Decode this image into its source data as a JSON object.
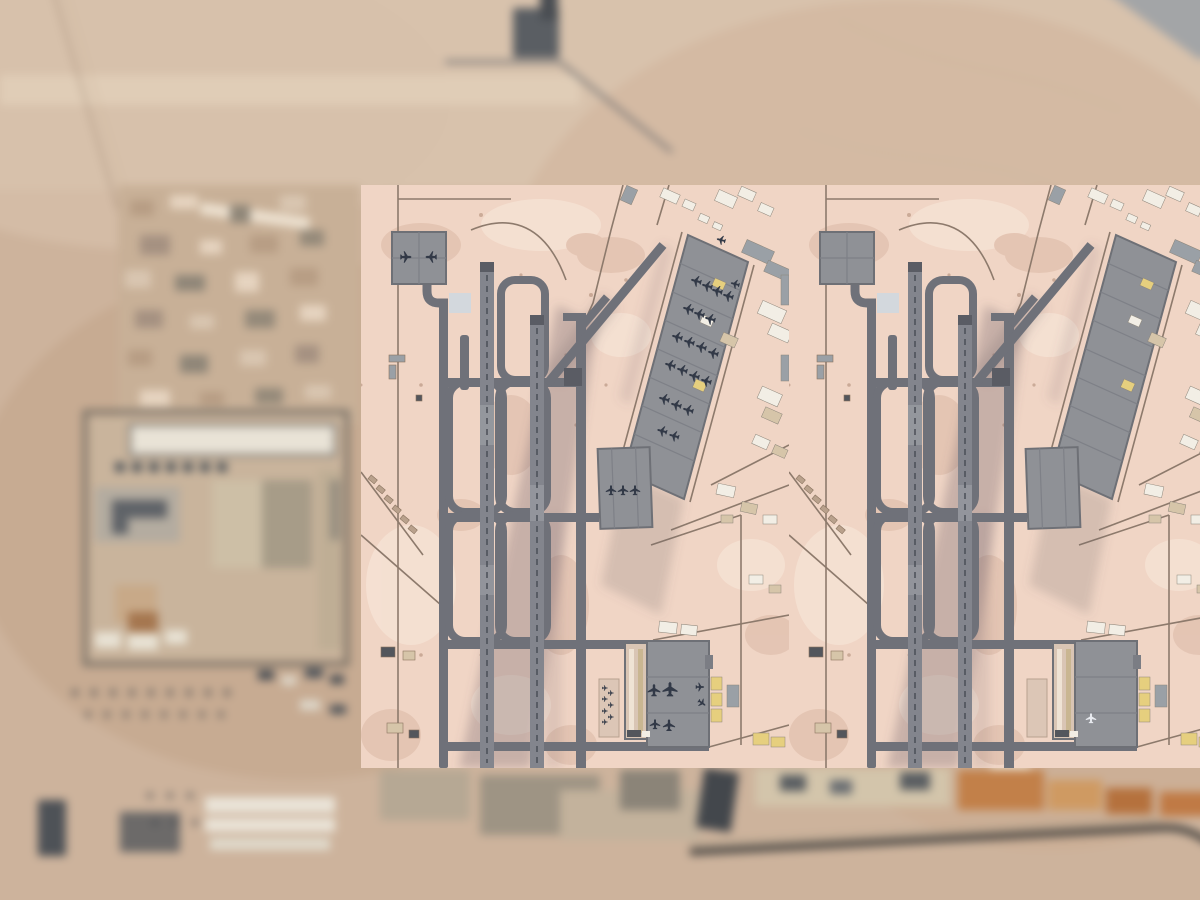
{
  "meta": {
    "description": "Composite satellite imagery: two crisp overhead panels of a desert airbase (runways, taxiways, parking aprons) laid over a blurred low-resolution aerial photograph of the same base",
    "content_type": "satellite-photo-comparison",
    "visible_text": ""
  },
  "colors": {
    "desert_base": "#cdb39c",
    "desert_light": "#dcc6b0",
    "panel_sand": "#f0d5c5",
    "mottle_dark": "#dbb8a5",
    "mottle_light": "#f9e9dc",
    "runway": "#83858d",
    "pavement": "#6f7179",
    "pavement_dark": "#5a5c64",
    "centerline": "#4b4e57",
    "apron": "#8f9196",
    "apron_edge": "#6e7076",
    "apron_lane": "#7e8087",
    "shadow": "#6b5e66",
    "road_thin": "#8d7a6c",
    "building_white": "#f2eee5",
    "building_tan": "#d6c5a9",
    "building_yellow": "#e6cf7e",
    "building_gray": "#9aa0a6",
    "dark_structure": "#53565c",
    "compound_wall": "#6f6a62",
    "road_dark": "#4b4844",
    "roof_orange": "#c28049",
    "roof_orange2": "#cf9a62",
    "plane": "#323947",
    "plane_light": "#e8eaef"
  },
  "panels": [
    {
      "id": "left",
      "name": "satellite-panel-left",
      "aircraft_visible": true,
      "aircraft_count": 40
    },
    {
      "id": "right",
      "name": "satellite-panel-right",
      "aircraft_visible": false,
      "aircraft_count": 1
    }
  ],
  "aircraft": {
    "left_panel": [
      {
        "x": 45,
        "y": 72,
        "r": 90,
        "s": 1.0
      },
      {
        "x": 70,
        "y": 72,
        "r": -90,
        "s": 1.0
      },
      {
        "x": 335,
        "y": 96,
        "r": -75,
        "s": 0.95
      },
      {
        "x": 346,
        "y": 101,
        "r": -75,
        "s": 0.95
      },
      {
        "x": 356,
        "y": 106,
        "r": -75,
        "s": 0.95
      },
      {
        "x": 367,
        "y": 111,
        "r": -75,
        "s": 0.95
      },
      {
        "x": 327,
        "y": 124,
        "r": -75,
        "s": 0.95
      },
      {
        "x": 338,
        "y": 129,
        "r": -75,
        "s": 0.95
      },
      {
        "x": 349,
        "y": 134,
        "r": -75,
        "s": 0.95
      },
      {
        "x": 316,
        "y": 152,
        "r": -75,
        "s": 0.95
      },
      {
        "x": 328,
        "y": 157,
        "r": -75,
        "s": 0.95
      },
      {
        "x": 340,
        "y": 162,
        "r": -75,
        "s": 0.95
      },
      {
        "x": 352,
        "y": 168,
        "r": -75,
        "s": 0.95
      },
      {
        "x": 309,
        "y": 180,
        "r": -75,
        "s": 0.95
      },
      {
        "x": 321,
        "y": 185,
        "r": -75,
        "s": 0.95
      },
      {
        "x": 333,
        "y": 191,
        "r": -75,
        "s": 0.95
      },
      {
        "x": 345,
        "y": 196,
        "r": -75,
        "s": 0.95
      },
      {
        "x": 303,
        "y": 214,
        "r": -75,
        "s": 0.95
      },
      {
        "x": 315,
        "y": 220,
        "r": -75,
        "s": 0.95
      },
      {
        "x": 327,
        "y": 225,
        "r": -75,
        "s": 0.95
      },
      {
        "x": 301,
        "y": 246,
        "r": -75,
        "s": 0.9
      },
      {
        "x": 313,
        "y": 251,
        "r": -75,
        "s": 0.9
      },
      {
        "x": 360,
        "y": 55,
        "r": -75,
        "s": 0.8
      },
      {
        "x": 374,
        "y": 99,
        "r": -75,
        "s": 0.8
      },
      {
        "x": 250,
        "y": 305,
        "r": 0,
        "s": 0.9
      },
      {
        "x": 262,
        "y": 305,
        "r": 0,
        "s": 0.9
      },
      {
        "x": 274,
        "y": 305,
        "r": 0,
        "s": 0.9
      },
      {
        "x": 293,
        "y": 505,
        "r": 0,
        "s": 1.1
      },
      {
        "x": 309,
        "y": 504,
        "r": 0,
        "s": 1.3
      },
      {
        "x": 339,
        "y": 502,
        "r": 90,
        "s": 0.75
      },
      {
        "x": 341,
        "y": 518,
        "r": 125,
        "s": 0.75
      },
      {
        "x": 294,
        "y": 539,
        "r": 0,
        "s": 0.9
      },
      {
        "x": 308,
        "y": 540,
        "r": 0,
        "s": 1.05
      },
      {
        "x": 244,
        "y": 503,
        "r": 90,
        "s": 0.5
      },
      {
        "x": 244,
        "y": 514,
        "r": 90,
        "s": 0.5
      },
      {
        "x": 244,
        "y": 526,
        "r": 90,
        "s": 0.5
      },
      {
        "x": 244,
        "y": 537,
        "r": 90,
        "s": 0.5
      },
      {
        "x": 250,
        "y": 508,
        "r": 90,
        "s": 0.5
      },
      {
        "x": 250,
        "y": 520,
        "r": 90,
        "s": 0.5
      },
      {
        "x": 250,
        "y": 532,
        "r": 90,
        "s": 0.5
      }
    ],
    "right_panel": [
      {
        "x": 302,
        "y": 533,
        "r": 0,
        "s": 0.9,
        "light": true
      }
    ],
    "background_rows": [
      {
        "y": 692,
        "x": 75,
        "count": 9,
        "step": 19,
        "s": 0.55
      },
      {
        "y": 714,
        "x": 88,
        "count": 8,
        "step": 19,
        "s": 0.5
      },
      {
        "y": 795,
        "x": 150,
        "count": 3,
        "step": 20,
        "s": 0.5
      },
      {
        "y": 822,
        "x": 155,
        "count": 3,
        "step": 20,
        "s": 0.5
      }
    ]
  }
}
